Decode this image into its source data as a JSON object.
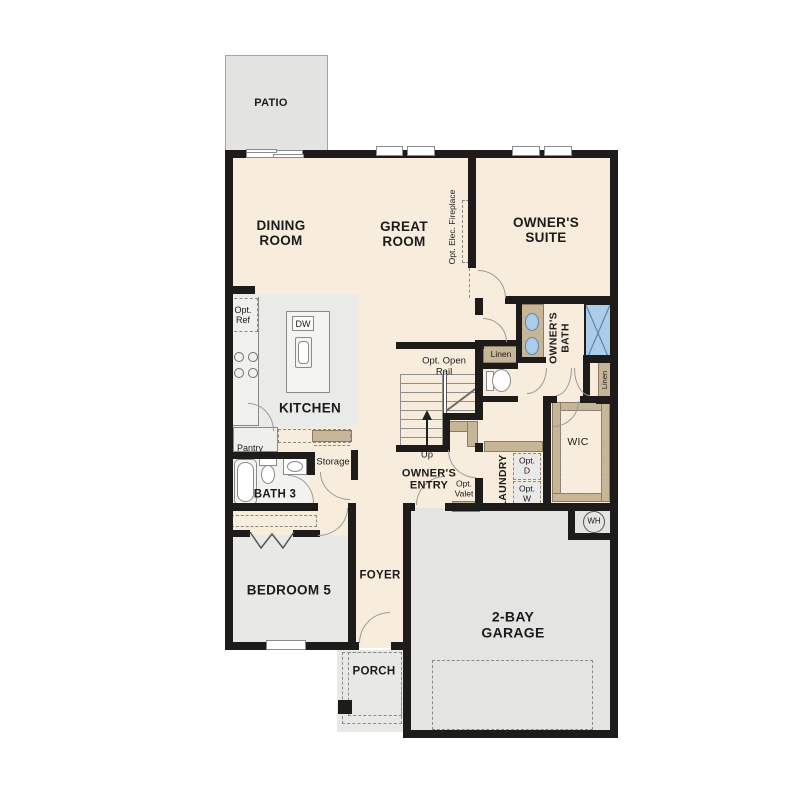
{
  "rooms": {
    "patio": "PATIO",
    "dining": "DINING\nROOM",
    "great": "GREAT\nROOM",
    "owners_suite": "OWNER'S\nSUITE",
    "kitchen": "KITCHEN",
    "bath3": "BATH 3",
    "bedroom5": "BEDROOM 5",
    "foyer": "FOYER",
    "porch": "PORCH",
    "garage": "2-BAY\nGARAGE",
    "owners_entry": "OWNER'S\nENTRY",
    "owners_bath": "OWNER'S\nBATH",
    "wic": "WIC",
    "laundry": "LAUNDRY"
  },
  "fixtures": {
    "opt_ref": "Opt.\nRef",
    "dw": "DW",
    "pantry": "Pantry",
    "storage": "Storage",
    "linen_left": "Linen",
    "linen_right": "Linen",
    "opt_open_rail": "Opt. Open\nRail",
    "up": "Up",
    "opt_valet": "Opt.\nValet",
    "opt_d": "Opt.\nD",
    "opt_w": "Opt.\nW",
    "water_heater": "WH",
    "opt_elec_fireplace": "Opt. Elec. Fireplace"
  },
  "colors": {
    "floor_cream": "#f8eddd",
    "floor_gray": "#e8e8e6",
    "garage_gray": "#e4e5e3",
    "accent_tan": "#c7b598",
    "fixture_blue": "#abcdea",
    "wall_black": "#1d1c1a"
  }
}
